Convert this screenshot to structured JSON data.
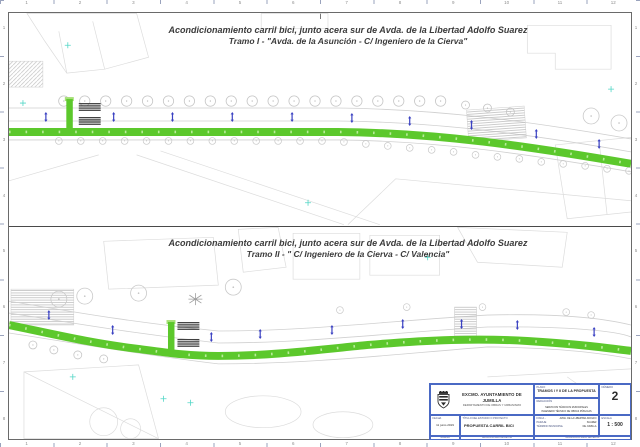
{
  "panels": [
    {
      "title_line1": "Acondicionamiento carril bici, junto acera sur de Avda. de la Libertad Adolfo Suarez",
      "title_line2": "Tramo I - \"Avda. de la Asunción - C/ Ingeniero de la Cierva\""
    },
    {
      "title_line1": "Acondicionamiento carril bici, junto acera sur de Avda. de la Libertad Adolfo Suarez",
      "title_line2": "Tramo II - \" C/ Ingeniero de la Cierva - C/ Valencia\""
    }
  ],
  "title_block": {
    "organization": "EXCMO. AYUNTAMIENTO DE JUMILLA",
    "department": "DEPARTAMENTO DE OBRAS Y URBANISMO",
    "plano_label": "PLANO",
    "plano_value": "TRAMOS I Y II DE LA PROPUESTA",
    "redaccion_label": "REDACCIÓN",
    "redaccion_line1": "SERVICIOS TÉCNICOS MUNICIPALES",
    "redaccion_line2": "INGENIERO TÉCNICO DE OBRAS PÚBLICAS",
    "numero_label": "NÚMERO",
    "numero_value": "2",
    "fecha_label": "FECHA",
    "fecha_value": "11 junio 2019",
    "titulo_label": "TÍTULO DEL ESTUDIO O PROYECTO",
    "titulo_value": "PROPUESTA CARRIL BICI",
    "finca_label": "FINCA - PARAJE",
    "finca_value": "AVDA. DE LA LIBERTAD ADOLFO SUAREZ",
    "termino_label": "TÉRMINO MUNICIPAL",
    "termino_value": "DE JUMILLA",
    "escala_label": "ESCALA",
    "escala_value": "1 : 500",
    "strip_left": "JUMILLA",
    "strip_center": "ANULA A PLANO DE FECHA",
    "strip_right": "MODIFICA A PLANO DE FECHA"
  },
  "ruler": {
    "horizontal_numbers": [
      "1",
      "2",
      "3",
      "4",
      "5",
      "6",
      "7",
      "8",
      "9",
      "10",
      "11",
      "12"
    ],
    "vertical_numbers": [
      "1",
      "2",
      "3",
      "4",
      "5",
      "6",
      "7",
      "8"
    ]
  },
  "colors": {
    "bike_lane_green": "#5cc82c",
    "bike_lane_dots": "#b9eb9b",
    "marker_blue": "#3a41c2",
    "title_block_border": "#4a69c4",
    "survey_cyan": "#52d6c6"
  }
}
